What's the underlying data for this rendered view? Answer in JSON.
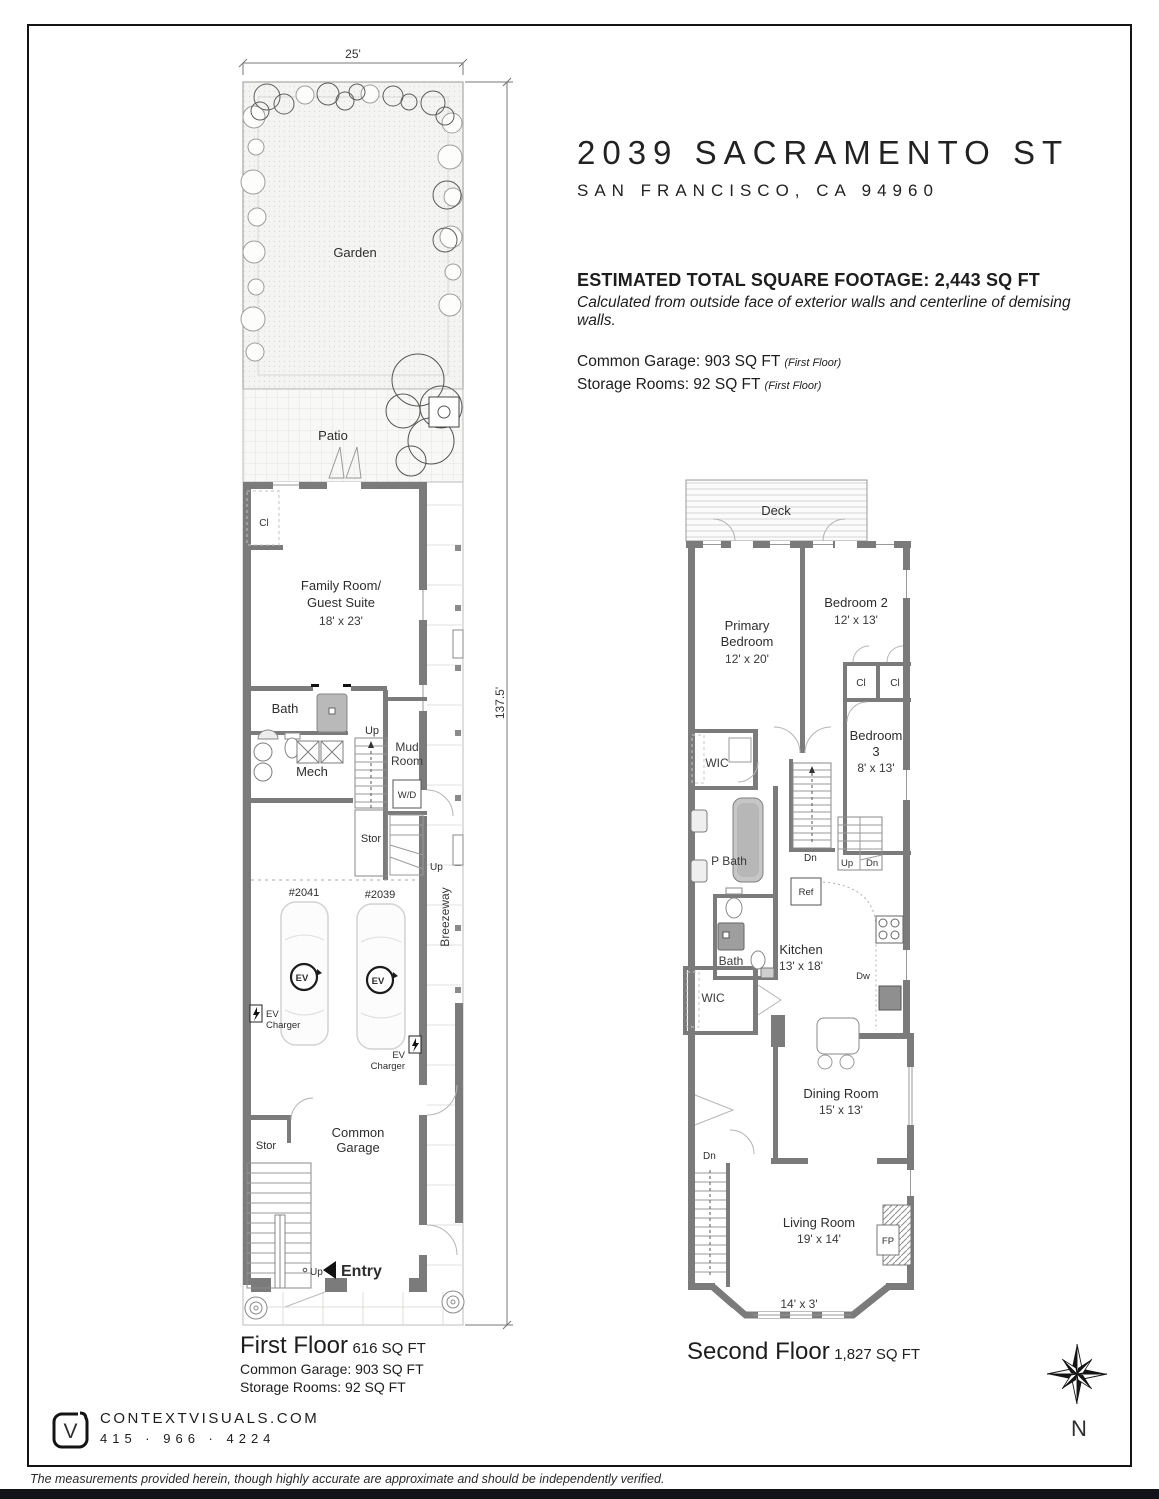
{
  "header": {
    "address": "2039 SACRAMENTO ST",
    "city": "SAN FRANCISCO, CA 94960",
    "total": "ESTIMATED TOTAL SQUARE FOOTAGE: 2,443 SQ FT",
    "note": "Calculated from outside face of exterior walls and centerline of demising walls.",
    "garage": "Common Garage: 903 SQ FT",
    "garage_floor": "(First Floor)",
    "storage": "Storage Rooms: 92 SQ FT",
    "storage_floor": "(First Floor)"
  },
  "first_floor": {
    "caption_title": "First Floor",
    "caption_area": "616 SQ FT",
    "caption_line2": "Common Garage: 903 SQ FT",
    "caption_line3": "Storage Rooms: 92 SQ FT",
    "dims": {
      "width": "25'",
      "depth": "137.5'"
    },
    "labels": {
      "garden": "Garden",
      "patio": "Patio",
      "closet": "Cl",
      "family1": "Family Room/",
      "family2": "Guest Suite",
      "family_dim": "18' x 23'",
      "bath": "Bath",
      "mech": "Mech",
      "up_main": "Up",
      "mud1": "Mud",
      "mud2": "Room",
      "wd": "W/D",
      "stor_mid": "Stor",
      "up_mid": "Up",
      "unit_2041": "#2041",
      "unit_2039": "#2039",
      "ev": "EV",
      "ev_charger1": "EV",
      "ev_charger2": "Charger",
      "breezeway": "Breezeway",
      "garage1": "Common",
      "garage2": "Garage",
      "stor_low": "Stor",
      "up_entry": "Up",
      "entry": "Entry"
    }
  },
  "second_floor": {
    "caption_title": "Second Floor",
    "caption_area": "1,827 SQ FT",
    "labels": {
      "deck": "Deck",
      "primary1": "Primary",
      "primary2": "Bedroom",
      "primary_dim": "12' x 20'",
      "bedroom2": "Bedroom 2",
      "bedroom2_dim": "12' x 13'",
      "cl_a": "Cl",
      "cl_b": "Cl",
      "bedroom3_1": "Bedroom",
      "bedroom3_2": "3",
      "bedroom3_dim": "8' x 13'",
      "wic_upper": "WIC",
      "dn_mid": "Dn",
      "up_stair": "Up",
      "dn_stair": "Dn",
      "pbath": "P Bath",
      "ref": "Ref",
      "bath": "Bath",
      "kitchen": "Kitchen",
      "kitchen_dim": "13' x 18'",
      "dw": "Dw",
      "wic_lower": "WIC",
      "dining": "Dining Room",
      "dining_dim": "15' x 13'",
      "dn_lower": "Dn",
      "living": "Living Room",
      "living_dim": "19' x 14'",
      "fp": "FP",
      "bay_dim": "14' x 3'"
    }
  },
  "footer": {
    "logo_letter": "V",
    "website": "CONTEXTVISUALS.COM",
    "phone": "415 · 966 · 4224",
    "compass": "N",
    "disclaimer": "The measurements provided herein, though highly accurate are approximate and should be independently verified."
  }
}
